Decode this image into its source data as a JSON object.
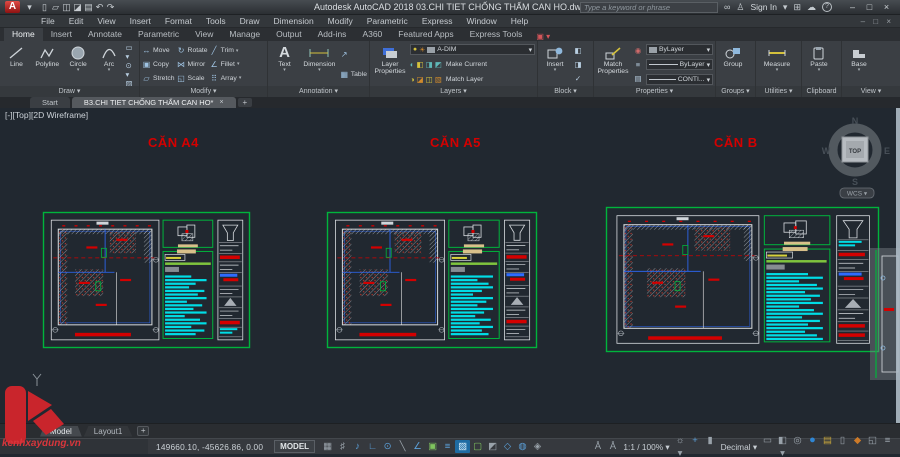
{
  "app": {
    "title": "Autodesk AutoCAD 2018   03.CHI TIET CHỐNG THẤM CAN HO.dwg",
    "search_placeholder": "Type a keyword or phrase",
    "sign_in": "Sign In",
    "qat_icons": [
      {
        "name": "new-file-icon",
        "glyph": "▯"
      },
      {
        "name": "open-file-icon",
        "glyph": "▱"
      },
      {
        "name": "save-icon",
        "glyph": "◫"
      },
      {
        "name": "save-as-icon",
        "glyph": "◪"
      },
      {
        "name": "plot-icon",
        "glyph": "▤"
      },
      {
        "name": "undo-icon",
        "glyph": "↶"
      },
      {
        "name": "redo-icon",
        "glyph": "↷"
      }
    ],
    "window_buttons": {
      "minimize": "–",
      "maximize": "□",
      "close": "×"
    }
  },
  "menubar": {
    "items": [
      "File",
      "Edit",
      "View",
      "Insert",
      "Format",
      "Tools",
      "Draw",
      "Dimension",
      "Modify",
      "Parametric",
      "Express",
      "Window",
      "Help"
    ],
    "winctl": "– □ ×"
  },
  "ribbon": {
    "tabs": [
      {
        "label": "Home",
        "active": true
      },
      {
        "label": "Insert"
      },
      {
        "label": "Annotate"
      },
      {
        "label": "Parametric"
      },
      {
        "label": "View"
      },
      {
        "label": "Manage"
      },
      {
        "label": "Output"
      },
      {
        "label": "Add-ins"
      },
      {
        "label": "A360"
      },
      {
        "label": "Featured Apps"
      },
      {
        "label": "Express Tools"
      }
    ],
    "draw": {
      "label": "Draw ▾",
      "line": "Line",
      "polyline": "Polyline",
      "circle": "Circle",
      "arc": "Arc"
    },
    "modify": {
      "label": "Modify ▾",
      "items": [
        "Move",
        "Rotate",
        "Trim",
        "Copy",
        "Mirror",
        "Fillet",
        "Stretch",
        "Scale",
        "Array"
      ],
      "icons": [
        "↔",
        "↻",
        "╱",
        "▣",
        "⋈",
        "∠",
        "▱",
        "◱",
        "⠿"
      ],
      "carets": [
        false,
        false,
        true,
        false,
        false,
        true,
        false,
        false,
        true
      ]
    },
    "annotation": {
      "label": "Annotation ▾",
      "text": "Text",
      "dimension": "Dimension",
      "table": "Table"
    },
    "layers": {
      "label": "Layers ▾",
      "layer_properties": "Layer Properties",
      "combo_value": "A-DIM",
      "make_current": "Make Current",
      "match_layer": "Match Layer"
    },
    "block": {
      "label": "Block ▾",
      "insert": "Insert"
    },
    "properties": {
      "label": "Properties ▾",
      "match_properties": "Match Properties",
      "combos": [
        "ByLayer",
        "ByLayer",
        "CONTI..."
      ]
    },
    "groups": {
      "label": "Groups ▾",
      "group": "Group"
    },
    "utilities": {
      "label": "Utilities ▾",
      "measure": "Measure"
    },
    "clipboard": {
      "label": "Clipboard",
      "paste": "Paste"
    },
    "view": {
      "label": "View ▾",
      "base": "Base"
    }
  },
  "file_tabs": {
    "start": "Start",
    "active": "B3.CHI TIET CHỐNG THẤM CAN HO*",
    "close": "×",
    "add": "+"
  },
  "viewport": {
    "controls": "[-][Top][2D Wireframe]",
    "viewcube": {
      "n": "N",
      "e": "E",
      "s": "S",
      "w": "W",
      "top": "TOP",
      "wcs": "WCS ▾"
    }
  },
  "canvas": {
    "colors": {
      "bg": "#212830",
      "green": "#00b43c",
      "cyan": "#00dde6",
      "red": "#d40000",
      "white": "#d8dce0",
      "blue": "#2e6bff"
    },
    "labels": [
      {
        "text": "CĂN A4",
        "x": 148,
        "y": 27
      },
      {
        "text": "CĂN A5",
        "x": 430,
        "y": 27
      },
      {
        "text": "CĂN B",
        "x": 714,
        "y": 27
      }
    ],
    "drawings": [
      {
        "name": "can-a4",
        "box": {
          "x": 43,
          "y": 104,
          "w": 207,
          "h": 136
        },
        "bars": [
          0.6,
          0.95,
          0.7,
          0.55,
          0.9,
          0.75,
          0.95,
          0.5,
          0.85,
          0.65,
          0.95,
          0.45,
          0.8,
          0.95,
          0.6,
          0.9,
          0.7,
          0.95
        ],
        "details": [
          "wplan",
          "wlines",
          "red",
          "wlines",
          "bluered",
          "wlines",
          "tri",
          "wlines",
          "red",
          "cyan"
        ]
      },
      {
        "name": "can-a5",
        "box": {
          "x": 327,
          "y": 104,
          "w": 210,
          "h": 136
        },
        "bars": [
          0.95,
          0.6,
          0.85,
          0.95,
          0.7,
          0.5,
          0.95,
          0.8,
          0.6,
          0.95,
          0.75,
          0.55,
          0.9,
          0.65,
          0.95,
          0.7,
          0.85,
          0.5
        ],
        "details": [
          "wplan",
          "wlines",
          "red",
          "wlines",
          "bluered",
          "wlines",
          "tri",
          "wlines",
          "red",
          "wlines"
        ]
      },
      {
        "name": "can-b",
        "box": {
          "x": 606,
          "y": 99,
          "w": 273,
          "h": 145
        },
        "bars": [
          0.7,
          0.95,
          0.55,
          0.85,
          0.95,
          0.65,
          0.9,
          0.75,
          0.95,
          0.55,
          0.8,
          0.95,
          0.6,
          0.9,
          0.7,
          0.95,
          0.65,
          0.85,
          0.95
        ],
        "details": [
          "wplan",
          "cyan",
          "red",
          "wlines",
          "bluered",
          "wlines",
          "tri",
          "wlines",
          "red",
          "red"
        ]
      }
    ]
  },
  "watermark": {
    "text": "kenhxaydung.vn"
  },
  "model_tabs": {
    "tabs": [
      {
        "label": "Model",
        "active": true
      },
      {
        "label": "Layout1",
        "active": false
      }
    ],
    "add": "+"
  },
  "statusbar": {
    "coords": "149660.10, -45626.86, 0.00",
    "model": "MODEL",
    "toggles": [
      {
        "name": "grid-display-icon",
        "glyph": "▦",
        "c": "gray"
      },
      {
        "name": "snap-mode-icon",
        "glyph": "♯",
        "c": "gray"
      },
      {
        "name": "dynamic-input-icon",
        "glyph": "♪",
        "c": "blue"
      },
      {
        "name": "ortho-mode-icon",
        "glyph": "∟",
        "c": "blue"
      },
      {
        "name": "polar-tracking-icon",
        "glyph": "⊙",
        "c": "blue"
      },
      {
        "name": "isometric-drafting-icon",
        "glyph": "╲",
        "c": "gray"
      },
      {
        "name": "object-snap-tracking-icon",
        "glyph": "∠",
        "c": "blue"
      },
      {
        "name": "object-snap-icon",
        "glyph": "▣",
        "c": "green"
      },
      {
        "name": "lineweight-icon",
        "glyph": "≡",
        "c": "blue"
      },
      {
        "name": "transparency-icon",
        "glyph": "▨",
        "c": "active"
      },
      {
        "name": "selection-cycling-icon",
        "glyph": "▢",
        "c": "green"
      },
      {
        "name": "threed-object-snap-icon",
        "glyph": "◩",
        "c": "gray"
      },
      {
        "name": "dynamic-ucs-icon",
        "glyph": "◇",
        "c": "blue"
      },
      {
        "name": "selection-filter-icon",
        "glyph": "◍",
        "c": "blue"
      },
      {
        "name": "gizmo-icon",
        "glyph": "◈",
        "c": "gray"
      }
    ],
    "annotation_icons": [
      {
        "name": "annotation-visibility-icon",
        "glyph": "Å",
        "c": "gray"
      },
      {
        "name": "annotation-autoscale-icon",
        "glyph": "Å",
        "c": "gray"
      }
    ],
    "scale": "1:1 / 100% ▾",
    "units": "Decimal ▾",
    "right_icons": [
      {
        "name": "annotation-scale-gear-icon",
        "glyph": "☼ ▾",
        "c": "gray"
      },
      {
        "name": "workspace-switching-icon",
        "glyph": "+",
        "c": "blue"
      },
      {
        "name": "annotation-monitor-icon",
        "glyph": "▮",
        "c": "gray"
      },
      {
        "name": "units-icon",
        "glyph": "▭",
        "c": "gray"
      },
      {
        "name": "quick-properties-icon",
        "glyph": "◧ ▾",
        "c": "gray"
      },
      {
        "name": "isolate-objects-icon",
        "glyph": "◎",
        "c": "gray"
      },
      {
        "name": "graphics-performance-icon",
        "glyph": "●",
        "c": "perf"
      },
      {
        "name": "trusted-autodesk-icon",
        "glyph": "▤",
        "c": "yellow"
      },
      {
        "name": "clean-screen-doc-icon",
        "glyph": "▯",
        "c": "gray"
      },
      {
        "name": "security-lock-icon",
        "glyph": "◆",
        "c": "orange"
      },
      {
        "name": "clean-screen-icon",
        "glyph": "◱",
        "c": "gray"
      },
      {
        "name": "customization-icon",
        "glyph": "≡",
        "c": "gray"
      }
    ]
  }
}
